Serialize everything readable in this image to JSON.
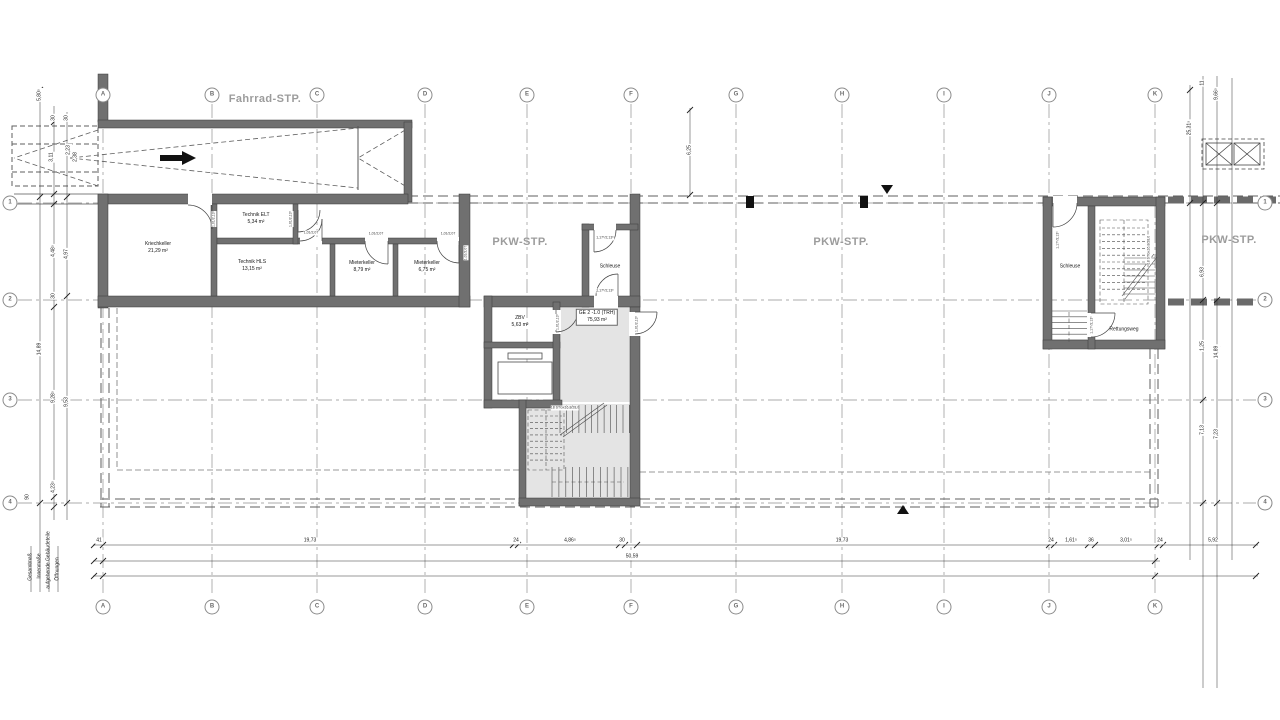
{
  "drawing": {
    "area_labels": [
      {
        "text": "Fahrrad-STP.",
        "x": 265,
        "y": 100
      },
      {
        "text": "PKW-STP.",
        "x": 520,
        "y": 243
      },
      {
        "text": "PKW-STP.",
        "x": 841,
        "y": 243
      },
      {
        "text": "PKW-STP.",
        "x": 1229,
        "y": 241
      }
    ],
    "grid": {
      "top_y": 95,
      "bottom_y": 607,
      "left_x": 10,
      "right_x": 1265,
      "columns": [
        {
          "label": "A",
          "x": 103
        },
        {
          "label": "B",
          "x": 212
        },
        {
          "label": "C",
          "x": 317
        },
        {
          "label": "D",
          "x": 425
        },
        {
          "label": "E",
          "x": 527
        },
        {
          "label": "F",
          "x": 631
        },
        {
          "label": "G",
          "x": 736
        },
        {
          "label": "H",
          "x": 842
        },
        {
          "label": "I",
          "x": 944
        },
        {
          "label": "J",
          "x": 1049
        },
        {
          "label": "K",
          "x": 1155
        }
      ],
      "rows": [
        {
          "label": "1",
          "y": 203
        },
        {
          "label": "2",
          "y": 300
        },
        {
          "label": "3",
          "y": 400
        },
        {
          "label": "4",
          "y": 503
        }
      ]
    },
    "rooms": [
      {
        "name": "Kriechkeller",
        "area": "21,29 m²",
        "x": 158,
        "y": 248
      },
      {
        "name": "Technik ELT",
        "area": "5,34 m²",
        "x": 256,
        "y": 219
      },
      {
        "name": "Technik HLS",
        "area": "13,15 m²",
        "x": 252,
        "y": 266
      },
      {
        "name": "Mieterkeller",
        "area": "8,79 m²",
        "x": 362,
        "y": 267
      },
      {
        "name": "Mieterkeller",
        "area": "6,75 m²",
        "x": 427,
        "y": 267
      },
      {
        "name": "Schleuse",
        "area": "",
        "x": 610,
        "y": 267
      },
      {
        "name": "ZBV",
        "area": "5,63 m²",
        "x": 520,
        "y": 322
      },
      {
        "name": "GE 2 -1.0 (TRH)",
        "area": "75,93 m²",
        "x": 597,
        "y": 317,
        "boxed": true
      },
      {
        "name": "Schleuse",
        "area": "",
        "x": 1070,
        "y": 267
      },
      {
        "name": "Rettungsweg",
        "area": "",
        "x": 1124,
        "y": 330
      }
    ],
    "stair_notes": [
      {
        "text": "18 STGx16,8/28,0",
        "x": 565,
        "y": 408,
        "rot": 0
      },
      {
        "text": "18 STGx16,8/28,0",
        "x": 1149,
        "y": 250,
        "rot": -90
      }
    ],
    "door_tags": [
      {
        "text": "1,01/2,13⁵",
        "x": 214,
        "y": 219,
        "rot": -90
      },
      {
        "text": "1,01/2,13⁵",
        "x": 291,
        "y": 219,
        "rot": -90
      },
      {
        "text": "1,01/2,07",
        "x": 311,
        "y": 233,
        "rot": 0
      },
      {
        "text": "1,01/2,07",
        "x": 376,
        "y": 234,
        "rot": 0
      },
      {
        "text": "1,01/2,07",
        "x": 448,
        "y": 234,
        "rot": 0
      },
      {
        "text": "1,01/2,07",
        "x": 466,
        "y": 253,
        "rot": -90
      },
      {
        "text": "1,17⁵/2,13⁵",
        "x": 605,
        "y": 238,
        "rot": 0
      },
      {
        "text": "1,17⁵/2,13⁵",
        "x": 605,
        "y": 291,
        "rot": 0
      },
      {
        "text": "1,01/2,13⁵",
        "x": 558,
        "y": 322,
        "rot": -90
      },
      {
        "text": "1,01/2,13⁵",
        "x": 637,
        "y": 324,
        "rot": -90
      },
      {
        "text": "1,17⁵/2,13⁵",
        "x": 1058,
        "y": 240,
        "rot": -90
      },
      {
        "text": "1,17⁵/2,13⁵",
        "x": 1092,
        "y": 325,
        "rot": -90
      }
    ],
    "h_dims": [
      {
        "text": "41",
        "x": 99,
        "y": 541
      },
      {
        "text": "19,73",
        "x": 310,
        "y": 541
      },
      {
        "text": "24",
        "x": 516,
        "y": 541
      },
      {
        "text": "4,86⁵",
        "x": 570,
        "y": 541
      },
      {
        "text": "30",
        "x": 622,
        "y": 541
      },
      {
        "text": "19,73",
        "x": 842,
        "y": 541
      },
      {
        "text": "24",
        "x": 1051,
        "y": 541
      },
      {
        "text": "1,61⁵",
        "x": 1071,
        "y": 541
      },
      {
        "text": "36",
        "x": 1091,
        "y": 541
      },
      {
        "text": "3,01⁵",
        "x": 1126,
        "y": 541
      },
      {
        "text": "24",
        "x": 1160,
        "y": 541
      },
      {
        "text": "5,92",
        "x": 1213,
        "y": 541
      },
      {
        "text": "50,59",
        "x": 632,
        "y": 557
      }
    ],
    "v_dims": [
      {
        "text": "5,80⁵",
        "x": 40,
        "y": 95
      },
      {
        "text": "30",
        "x": 54,
        "y": 118
      },
      {
        "text": "30",
        "x": 67,
        "y": 118
      },
      {
        "text": "3,11",
        "x": 52,
        "y": 157
      },
      {
        "text": "2,23",
        "x": 69,
        "y": 150
      },
      {
        "text": "2,38",
        "x": 76,
        "y": 157
      },
      {
        "text": "4,48⁵",
        "x": 54,
        "y": 251
      },
      {
        "text": "4,97",
        "x": 67,
        "y": 254
      },
      {
        "text": "30",
        "x": 54,
        "y": 296
      },
      {
        "text": "14,89",
        "x": 40,
        "y": 349
      },
      {
        "text": "9,28⁵",
        "x": 54,
        "y": 397
      },
      {
        "text": "9,53",
        "x": 67,
        "y": 402
      },
      {
        "text": "4,23⁵",
        "x": 54,
        "y": 487
      },
      {
        "text": "90",
        "x": 28,
        "y": 497
      },
      {
        "text": "6,25",
        "x": 690,
        "y": 150
      },
      {
        "text": "25,31⁵",
        "x": 1190,
        "y": 128
      },
      {
        "text": "11",
        "x": 1203,
        "y": 83
      },
      {
        "text": "9,66⁵",
        "x": 1217,
        "y": 94
      },
      {
        "text": "6,93",
        "x": 1203,
        "y": 272
      },
      {
        "text": "1,25",
        "x": 1203,
        "y": 346
      },
      {
        "text": "14,89",
        "x": 1217,
        "y": 352
      },
      {
        "text": "7,13",
        "x": 1203,
        "y": 430
      },
      {
        "text": "7,23",
        "x": 1217,
        "y": 434
      }
    ],
    "chain_labels": [
      {
        "text": "Gesamtmaß",
        "x": 31,
        "y": 567
      },
      {
        "text": "Innenmaße",
        "x": 40,
        "y": 566
      },
      {
        "text": "aufgehende Gebäudeteile",
        "x": 49,
        "y": 560
      },
      {
        "text": "Öffnungen",
        "x": 58,
        "y": 569
      }
    ]
  }
}
